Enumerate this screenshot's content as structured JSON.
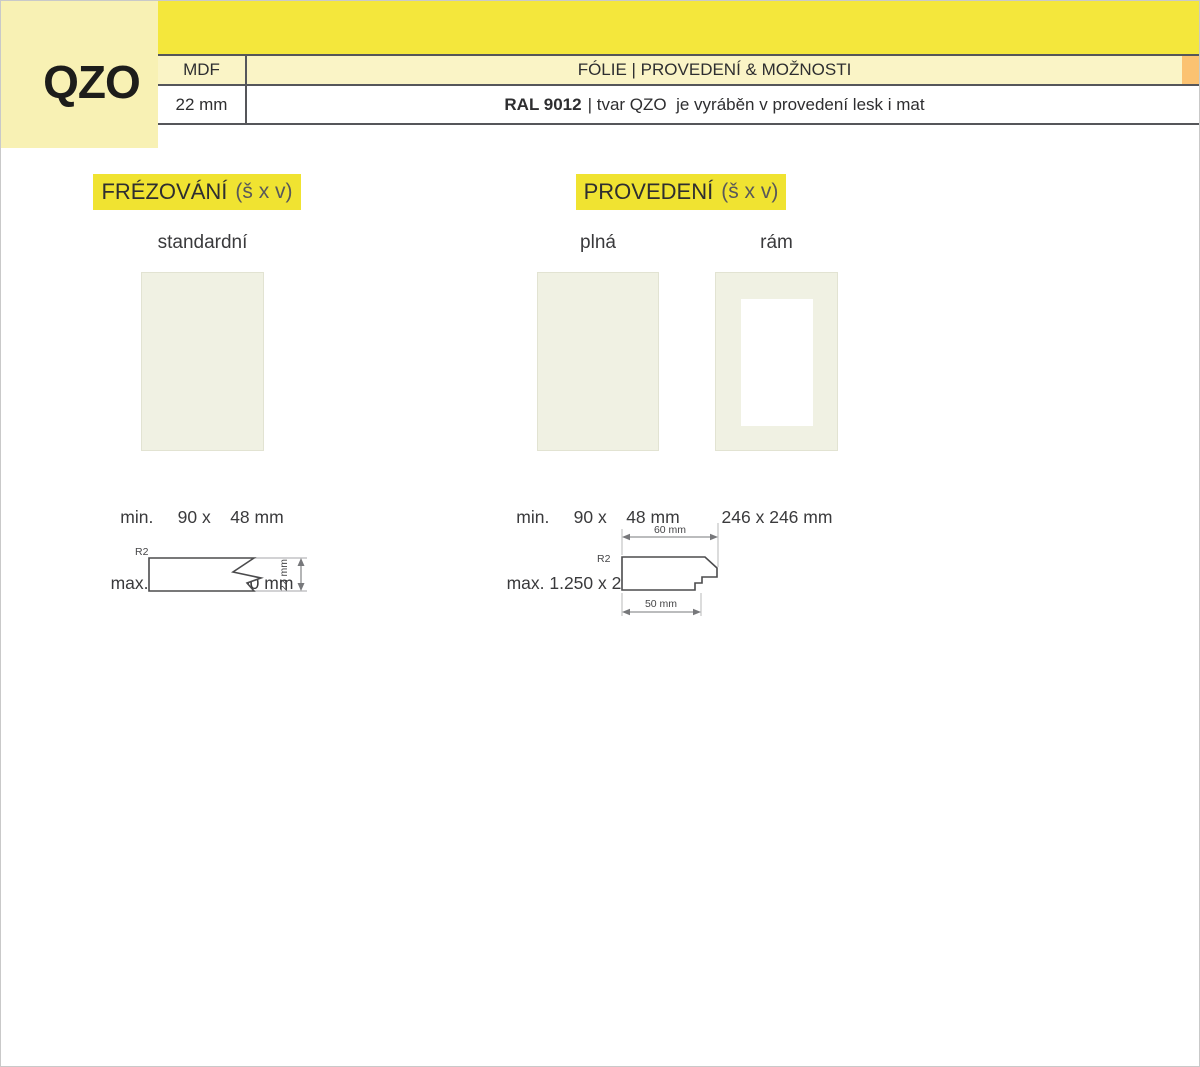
{
  "header": {
    "product_code": "QZO",
    "table": {
      "material": "MDF",
      "thickness": "22 mm",
      "title": "FÓLIE | PROVEDENÍ & MOŽNOSTI",
      "finish_code": "RAL 9012",
      "finish_description": "| tvar QZO  je vyráběn v provedení lesk i mat"
    }
  },
  "sections": [
    {
      "id": "frezovani",
      "title": "FRÉZOVÁNÍ",
      "title_suffix": "(š x v)",
      "variants": [
        {
          "label": "standardní",
          "dims": [
            "min.     90 x    48 mm",
            "max. 1.250 x 2.500 mm"
          ]
        }
      ]
    },
    {
      "id": "provedeni",
      "title": "PROVEDENÍ",
      "title_suffix": "(š x v)",
      "variants": [
        {
          "label": "plná",
          "dims": [
            "min.     90 x    48 mm",
            "max. 1.250 x 2.500 mm"
          ]
        },
        {
          "label": "rám",
          "dims": [
            "246 x 246 mm"
          ]
        }
      ]
    }
  ],
  "drawings": {
    "standard_profile": {
      "radius": "R2",
      "height": "22 mm"
    },
    "frame_profile": {
      "radius": "R2",
      "width_top": "60 mm",
      "width_bottom": "50 mm"
    }
  },
  "colors": {
    "brand_yellow": "#F4E73C",
    "pale_yellow": "#F8F1B4",
    "table_row_yellow": "#FAF4C6",
    "accent_orange": "#FBC271",
    "highlight_yellow": "#F0E331",
    "swatch_cream": "#F0F1E3"
  }
}
